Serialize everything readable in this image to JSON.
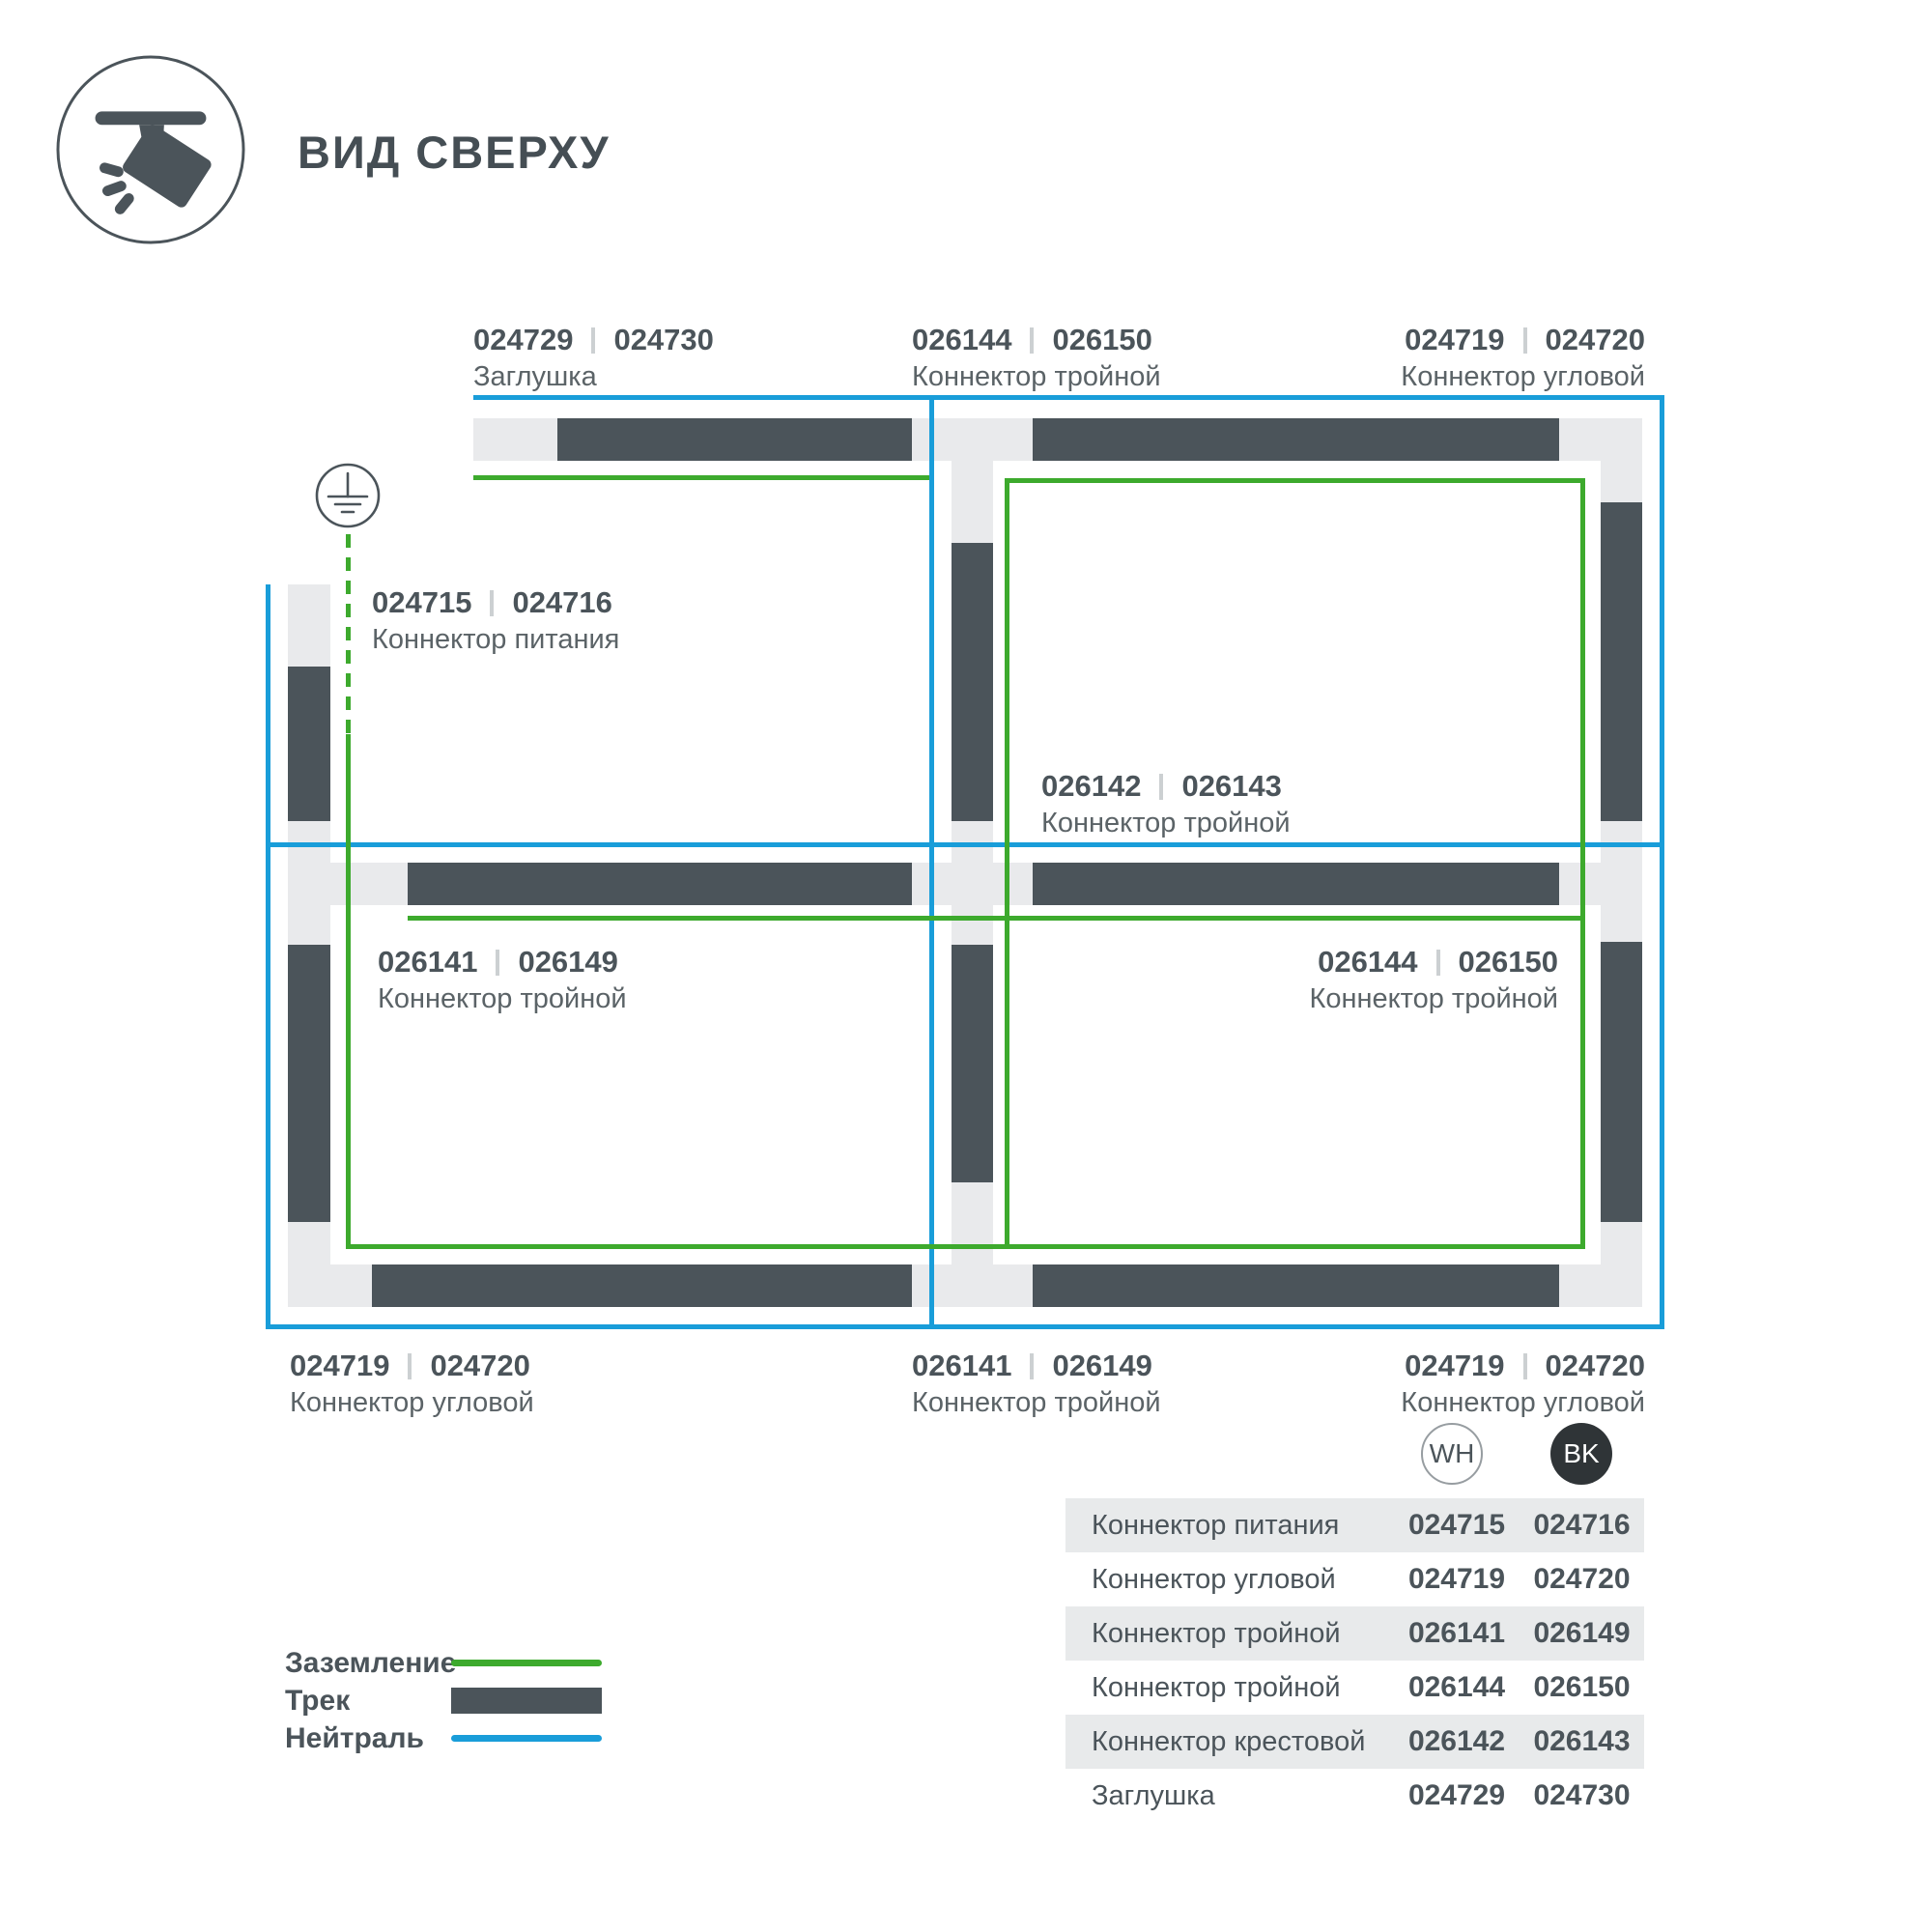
{
  "header": {
    "title": "ВИД СВЕРХУ"
  },
  "colors": {
    "track_dark": "#4b545a",
    "connector_gray": "#e9eaec",
    "ground_green": "#3daa2d",
    "neutral_blue": "#199dd9"
  },
  "diagram": {
    "icon": "track-spotlight",
    "labels": [
      {
        "a": "024729",
        "b": "024730",
        "name": "Заглушка"
      },
      {
        "a": "026144",
        "b": "026150",
        "name": "Коннектор тройной"
      },
      {
        "a": "024719",
        "b": "024720",
        "name": "Коннектор угловой"
      },
      {
        "a": "024715",
        "b": "024716",
        "name": "Коннектор питания"
      },
      {
        "a": "026142",
        "b": "026143",
        "name": "Коннектор тройной"
      },
      {
        "a": "026144",
        "b": "026150",
        "name": "Коннектор тройной"
      },
      {
        "a": "026141",
        "b": "026149",
        "name": "Коннектор тройной"
      },
      {
        "a": "024719",
        "b": "024720",
        "name": "Коннектор угловой"
      },
      {
        "a": "026141",
        "b": "026149",
        "name": "Коннектор тройной"
      },
      {
        "a": "024719",
        "b": "024720",
        "name": "Коннектор угловой"
      }
    ]
  },
  "badges": {
    "wh": "WH",
    "bk": "BK"
  },
  "table": {
    "rows": [
      {
        "name": "Коннектор питания",
        "wh": "024715",
        "bk": "024716"
      },
      {
        "name": "Коннектор угловой",
        "wh": "024719",
        "bk": "024720"
      },
      {
        "name": "Коннектор тройной",
        "wh": "026141",
        "bk": "026149"
      },
      {
        "name": "Коннектор тройной",
        "wh": "026144",
        "bk": "026150"
      },
      {
        "name": "Коннектор крестовой",
        "wh": "026142",
        "bk": "026143"
      },
      {
        "name": "Заглушка",
        "wh": "024729",
        "bk": "024730"
      }
    ]
  },
  "legend": {
    "items": [
      {
        "label": "Заземление"
      },
      {
        "label": "Трек"
      },
      {
        "label": "Нейтраль"
      }
    ]
  }
}
